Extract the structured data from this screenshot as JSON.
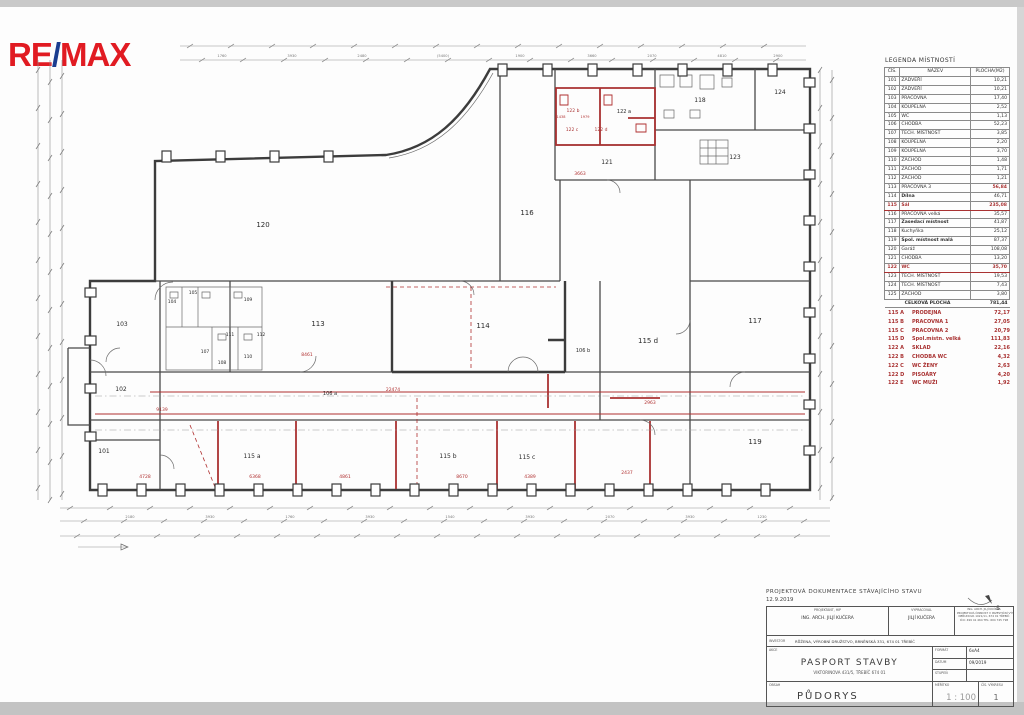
{
  "logo": {
    "re": "RE",
    "slash": "/",
    "max": "MAX"
  },
  "colors": {
    "logo_red": "#e11b22",
    "logo_blue": "#1b3d8f",
    "plan_red": "#a93232",
    "wall": "#3c3c3c"
  },
  "legend": {
    "title": "LEGENDA MÍSTNOSTÍ",
    "headers": [
      "ČÍS.",
      "NÁZEV",
      "PLOCHA(M2)"
    ],
    "rows": [
      {
        "num": "101",
        "name": "ZÁDVEŘÍ",
        "area": "10,21"
      },
      {
        "num": "102",
        "name": "ZÁDVEŘÍ",
        "area": "10,21"
      },
      {
        "num": "103",
        "name": "PRACOVNA",
        "area": "17,40"
      },
      {
        "num": "104",
        "name": "KOUPELNA",
        "area": "2,52"
      },
      {
        "num": "105",
        "name": "WC",
        "area": "1,13"
      },
      {
        "num": "106",
        "name": "CHODBA",
        "area": "52,23"
      },
      {
        "num": "107",
        "name": "TECH. MÍSTNOST",
        "area": "3,85"
      },
      {
        "num": "108",
        "name": "KOUPELNA",
        "area": "2,20"
      },
      {
        "num": "109",
        "name": "KOUPELNA",
        "area": "3,70"
      },
      {
        "num": "110",
        "name": "ZÁCHOD",
        "area": "1,48"
      },
      {
        "num": "111",
        "name": "ZÁCHOD",
        "area": "1,71"
      },
      {
        "num": "112",
        "name": "ZÁCHOD",
        "area": "1,21"
      },
      {
        "num": "113",
        "name": "PRACOVNA 3",
        "area": "56,84",
        "redarea": true
      },
      {
        "num": "114",
        "name": "Dílna",
        "area": "46,71",
        "bold": true
      },
      {
        "num": "115",
        "name": "Sál",
        "area": "235,08",
        "red": true
      },
      {
        "num": "116",
        "name": "PRACOVNA velká",
        "area": "35,57"
      },
      {
        "num": "117",
        "name": "Zasedací místnost",
        "area": "41,87",
        "bold": true
      },
      {
        "num": "118",
        "name": "Kuchyňka",
        "area": "25,12"
      },
      {
        "num": "119",
        "name": "Spol. místnost malá",
        "area": "87,37",
        "bold": true
      },
      {
        "num": "120",
        "name": "Garáž",
        "area": "108,08"
      },
      {
        "num": "121",
        "name": "CHODBA",
        "area": "13,20"
      },
      {
        "num": "122",
        "name": "WC",
        "area": "35,70",
        "red": true
      },
      {
        "num": "123",
        "name": "TECH. MÍSTNOST",
        "area": "19,53"
      },
      {
        "num": "124",
        "name": "TECH. MÍSTNOST",
        "area": "7,43"
      },
      {
        "num": "125",
        "name": "ZÁCHOD",
        "area": "3,80"
      }
    ],
    "total_label": "CELKOVÁ PLOCHA",
    "total_value": "781,44"
  },
  "sublist": [
    {
      "num": "115 A",
      "name": "PRODEJNA",
      "area": "72,17"
    },
    {
      "num": "115 B",
      "name": "PRACOVNA 1",
      "area": "27,05"
    },
    {
      "num": "115 C",
      "name": "PRACOVNA 2",
      "area": "20,79"
    },
    {
      "num": "115 D",
      "name": "Spol.místn. velká",
      "area": "111,83"
    },
    {
      "num": "122 A",
      "name": "SKLAD",
      "area": "22,16"
    },
    {
      "num": "122 B",
      "name": "CHODBA WC",
      "area": "4,32"
    },
    {
      "num": "122 C",
      "name": "WC ŽENY",
      "area": "2,63"
    },
    {
      "num": "122 D",
      "name": "PISOÁRY",
      "area": "4,20"
    },
    {
      "num": "122 E",
      "name": "WC MUŽI",
      "area": "1,92"
    }
  ],
  "plan": {
    "north_label": "S",
    "room_labels": [
      {
        "t": "101",
        "x": 104,
        "y": 453,
        "s": 6
      },
      {
        "t": "102",
        "x": 121,
        "y": 391,
        "s": 6
      },
      {
        "t": "103",
        "x": 122,
        "y": 326,
        "s": 6
      },
      {
        "t": "104",
        "x": 172,
        "y": 303,
        "s": 4.5
      },
      {
        "t": "105",
        "x": 193,
        "y": 294,
        "s": 4.5
      },
      {
        "t": "107",
        "x": 205,
        "y": 353,
        "s": 4.5
      },
      {
        "t": "108",
        "x": 222,
        "y": 364,
        "s": 4.5
      },
      {
        "t": "109",
        "x": 248,
        "y": 301,
        "s": 4.5
      },
      {
        "t": "110",
        "x": 248,
        "y": 358,
        "s": 4.5
      },
      {
        "t": "111",
        "x": 230,
        "y": 336,
        "s": 4.5
      },
      {
        "t": "112",
        "x": 261,
        "y": 336,
        "s": 4.5
      },
      {
        "t": "113",
        "x": 318,
        "y": 326,
        "s": 7
      },
      {
        "t": "114",
        "x": 483,
        "y": 328,
        "s": 7
      },
      {
        "t": "115 a",
        "x": 252,
        "y": 458,
        "s": 6
      },
      {
        "t": "115 b",
        "x": 448,
        "y": 458,
        "s": 6
      },
      {
        "t": "115 c",
        "x": 527,
        "y": 459,
        "s": 6
      },
      {
        "t": "115 d",
        "x": 648,
        "y": 343,
        "s": 7
      },
      {
        "t": "116",
        "x": 527,
        "y": 215,
        "s": 7
      },
      {
        "t": "117",
        "x": 755,
        "y": 323,
        "s": 7
      },
      {
        "t": "118",
        "x": 700,
        "y": 102,
        "s": 6
      },
      {
        "t": "119",
        "x": 755,
        "y": 444,
        "s": 7
      },
      {
        "t": "120",
        "x": 263,
        "y": 227,
        "s": 7
      },
      {
        "t": "121",
        "x": 607,
        "y": 164,
        "s": 6
      },
      {
        "t": "122 a",
        "x": 624,
        "y": 113,
        "s": 5
      },
      {
        "t": "122 b",
        "x": 573,
        "y": 112,
        "s": 4.5,
        "c": "red"
      },
      {
        "t": "122 c",
        "x": 572,
        "y": 131,
        "s": 4.5,
        "c": "red"
      },
      {
        "t": "122 d",
        "x": 601,
        "y": 131,
        "s": 4.5,
        "c": "red"
      },
      {
        "t": "123",
        "x": 735,
        "y": 159,
        "s": 6
      },
      {
        "t": "124",
        "x": 780,
        "y": 94,
        "s": 6
      },
      {
        "t": "106 a",
        "x": 330,
        "y": 395,
        "s": 5
      },
      {
        "t": "106 b",
        "x": 583,
        "y": 352,
        "s": 5
      }
    ],
    "red_dims": [
      {
        "t": "22474",
        "x": 393,
        "y": 391,
        "s": 4.5
      },
      {
        "t": "9139",
        "x": 162,
        "y": 411,
        "s": 4.5
      },
      {
        "t": "8461",
        "x": 307,
        "y": 356,
        "s": 4.5
      },
      {
        "t": "3663",
        "x": 580,
        "y": 175,
        "s": 4.5
      },
      {
        "t": "2963",
        "x": 650,
        "y": 404,
        "s": 4.5
      },
      {
        "t": "4728",
        "x": 145,
        "y": 478,
        "s": 4.5
      },
      {
        "t": "6368",
        "x": 255,
        "y": 478,
        "s": 4.5
      },
      {
        "t": "4861",
        "x": 345,
        "y": 478,
        "s": 4.5
      },
      {
        "t": "8670",
        "x": 462,
        "y": 478,
        "s": 4.5
      },
      {
        "t": "4389",
        "x": 530,
        "y": 478,
        "s": 4.5
      },
      {
        "t": "2437",
        "x": 627,
        "y": 474,
        "s": 4.5
      },
      {
        "t": "1438",
        "x": 561,
        "y": 118,
        "s": 3.5
      },
      {
        "t": "1979",
        "x": 585,
        "y": 118,
        "s": 3.5
      }
    ],
    "top_dims": [
      {
        "t": "1760",
        "x": 222
      },
      {
        "t": "3930",
        "x": 292
      },
      {
        "t": "2480",
        "x": 362
      },
      {
        "t": "(5400)",
        "x": 443
      },
      {
        "t": "1900",
        "x": 520
      },
      {
        "t": "3660",
        "x": 592
      },
      {
        "t": "2070",
        "x": 652
      },
      {
        "t": "4810",
        "x": 722
      },
      {
        "t": "2900",
        "x": 778
      }
    ],
    "bottom_dims": [
      {
        "t": "2180",
        "x": 130
      },
      {
        "t": "3930",
        "x": 210
      },
      {
        "t": "1760",
        "x": 290
      },
      {
        "t": "3930",
        "x": 370
      },
      {
        "t": "1540",
        "x": 450
      },
      {
        "t": "3930",
        "x": 530
      },
      {
        "t": "2070",
        "x": 610
      },
      {
        "t": "3930",
        "x": 690
      },
      {
        "t": "1230",
        "x": 762
      }
    ]
  },
  "titleblock": {
    "doc_title": "PROJEKTOVÁ DOKUMENTACE STÁVAJÍCÍHO STAVU",
    "doc_date": "12.9.2019",
    "projektant_label": "PROJEKTANT, HIP",
    "projektant": "ING. ARCH. JILJÍ KUČERA",
    "vypracoval_label": "VYPRACOVAL",
    "vypracoval": "JILJÍ KUČERA",
    "firm_lines": [
      "ING. ARCH. JILJÍ KUČERA",
      "PROJEKTOVÁ ČINNOST V INVESTIČNÍ VÝSTAVBĚ",
      "NERUDOVA 1021/11, 674 01 TŘEBÍČ",
      "IČO: 499 41 464   TEL: 604 745 798"
    ],
    "investor_label": "INVESTOR",
    "investor": "RŮŽENA, VÝROBNÍ DRUŽSTVO, BRNĚNSKÁ 331, 674 01 TŘEBÍČ",
    "akce_label": "AKCE",
    "akce": "PASPORT STAVBY",
    "akce_sub": "VIKTORINOVA 431/5, TŘEBÍČ 674 01",
    "format_label": "FORMÁT",
    "format": "6xA4",
    "datum_label": "DATUM",
    "datum": "09/2019",
    "stupen_label": "STUPEŇ",
    "stupen": "",
    "obsah_label": "OBSAH",
    "obsah": "PŮDORYS",
    "meritko_label": "MĚŘÍTKO",
    "meritko": "1 : 100",
    "vykres_label": "ČÍS. VÝKRESU",
    "vykres": "1"
  }
}
